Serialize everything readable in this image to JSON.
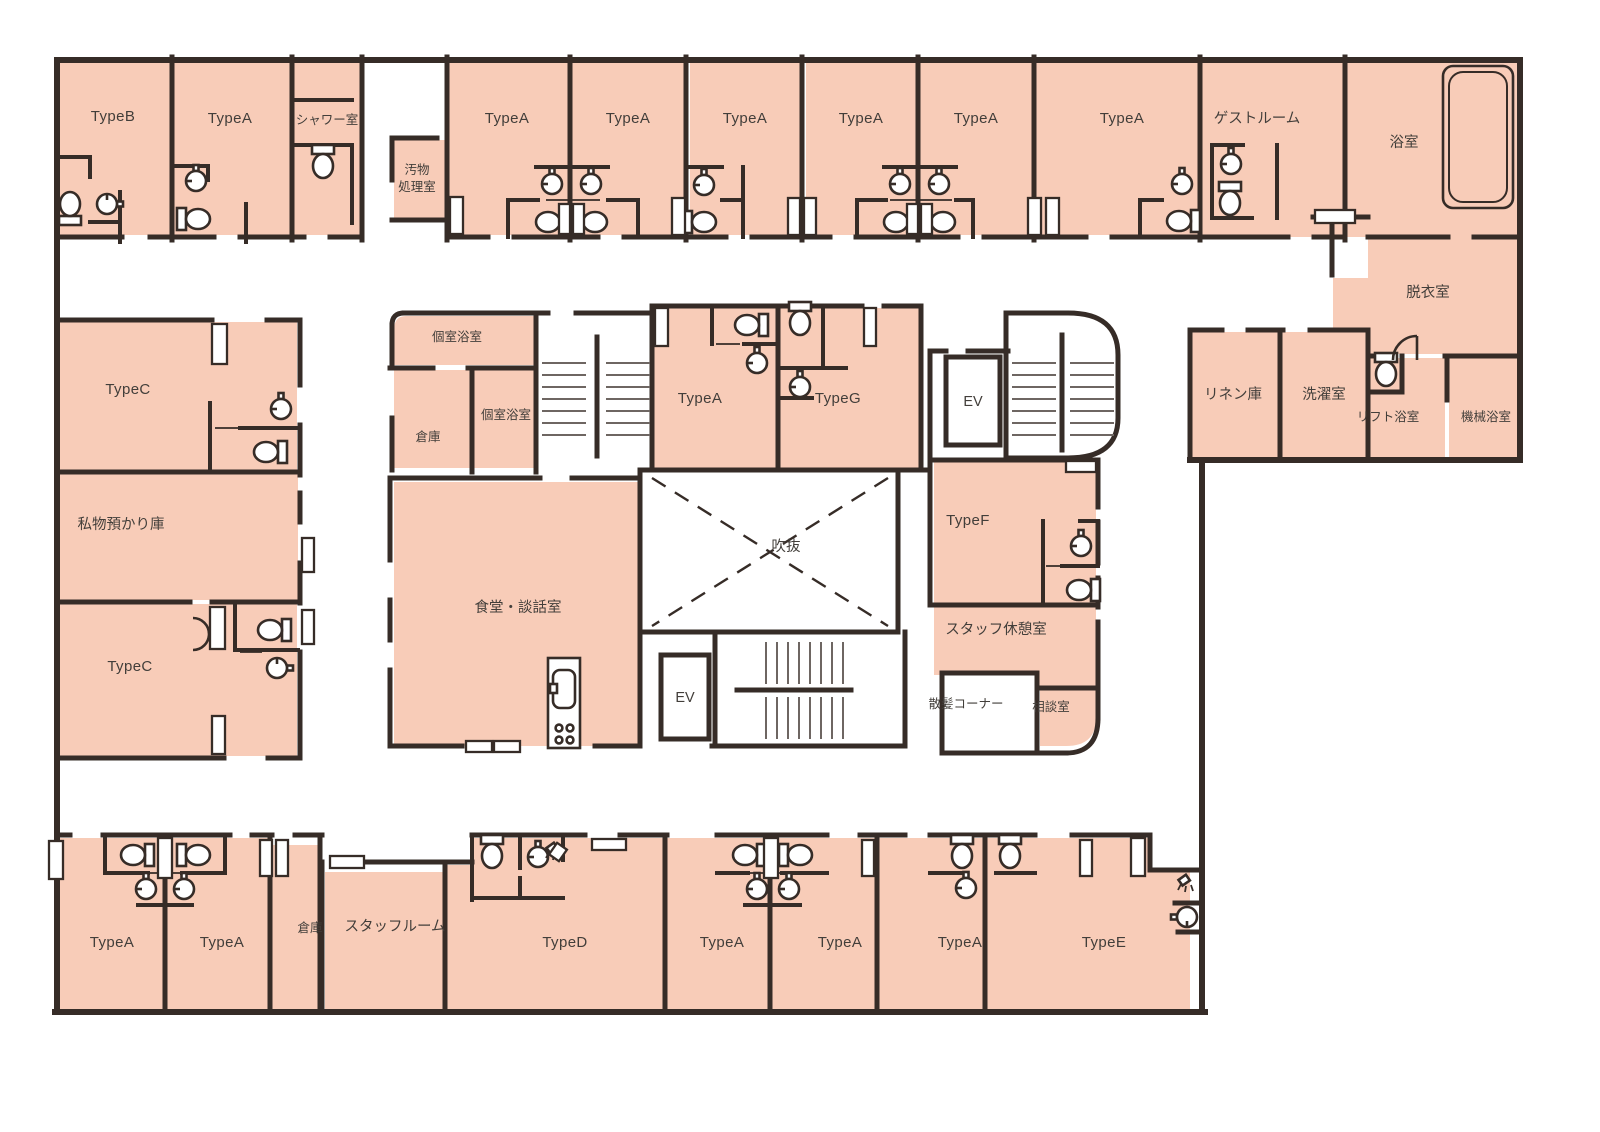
{
  "palette": {
    "background": "#ffffff",
    "room_fill": "#f8ccb8",
    "wall": "#362c27",
    "label_text": "#423e3a",
    "stair_line": "#6e6662"
  },
  "rooms": {
    "type_a": "TypeA",
    "type_b": "TypeB",
    "type_c": "TypeC",
    "type_d": "TypeD",
    "type_e": "TypeE",
    "type_f": "TypeF",
    "type_g": "TypeG",
    "shower_room": "シャワー室",
    "waste_processing_line1": "汚物",
    "waste_processing_line2": "処理室",
    "guest_room": "ゲストルーム",
    "bath_room": "浴室",
    "dressing_room": "脱衣室",
    "linen_storage": "リネン庫",
    "laundry_room": "洗濯室",
    "lift_bath": "リフト浴室",
    "machine_bath": "機械浴室",
    "personal_storage": "私物預かり庫",
    "private_bath": "個室浴室",
    "storage": "倉庫",
    "dining_lounge": "食堂・談話室",
    "atrium": "吹抜",
    "elevator": "EV",
    "staff_lounge": "スタッフ休憩室",
    "barber_corner": "散髪コーナー",
    "consultation_room": "相談室",
    "staff_room": "スタッフルーム"
  }
}
